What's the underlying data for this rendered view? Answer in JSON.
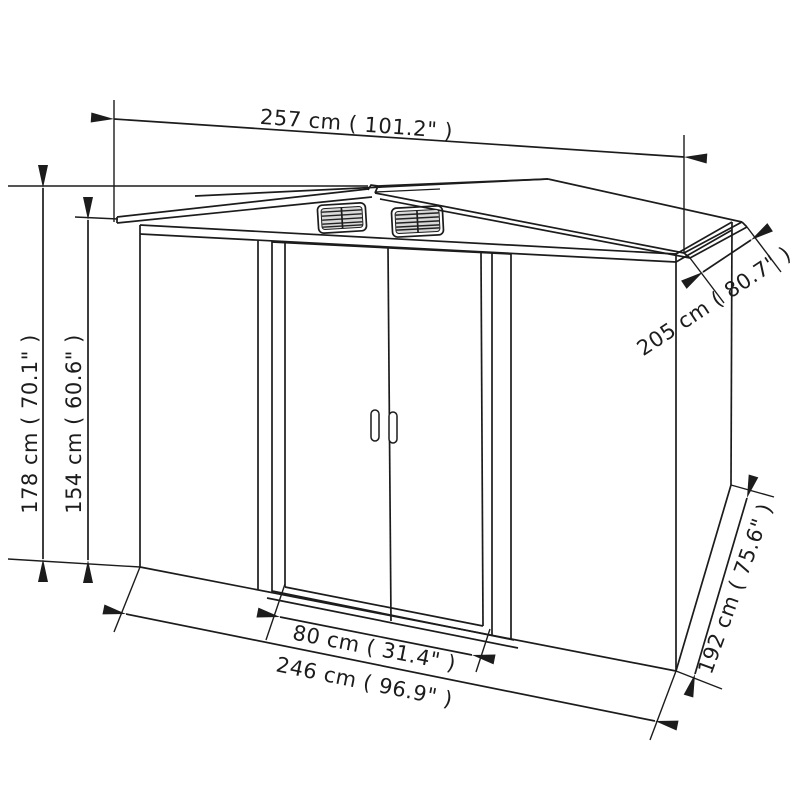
{
  "diagram": {
    "type": "product-dimension-diagram",
    "subject": "metal garden shed with double sliding doors and gable roof vents",
    "line_color": "#1c1c1c",
    "background_color": "#ffffff",
    "dimensions": {
      "roof_width": {
        "label": "257 cm ( 101.2\" )",
        "cm": 257,
        "inches": 101.2
      },
      "roof_depth": {
        "label": "205 cm ( 80.7\" )",
        "cm": 205,
        "inches": 80.7
      },
      "overall_height": {
        "label": "178 cm ( 70.1\" )",
        "cm": 178,
        "inches": 70.1
      },
      "eave_height": {
        "label": "154 cm ( 60.6\" )",
        "cm": 154,
        "inches": 60.6
      },
      "door_width": {
        "label": "80 cm ( 31.4\" )",
        "cm": 80,
        "inches": 31.4
      },
      "base_width": {
        "label": "246 cm ( 96.9\" )",
        "cm": 246,
        "inches": 96.9
      },
      "base_depth": {
        "label": "192 cm ( 75.6\" )",
        "cm": 192,
        "inches": 75.6
      }
    }
  }
}
